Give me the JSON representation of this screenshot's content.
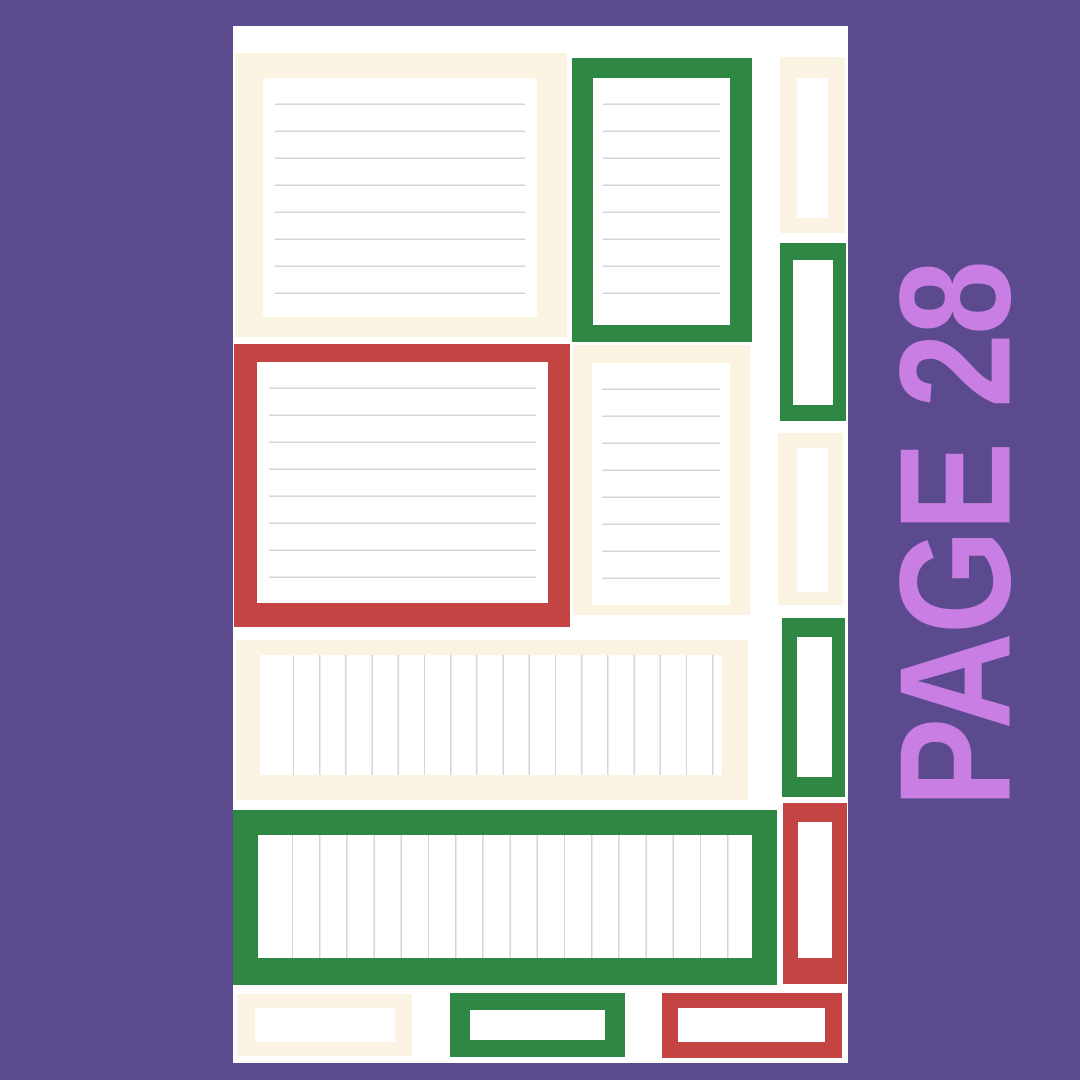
{
  "page": {
    "label": "PAGE 28"
  },
  "palette": {
    "background": "#5b4a8e",
    "label_text": "#c87ee2",
    "sheet": "#ffffff",
    "cream": "#faf3e1",
    "green": "#2e8742",
    "red": "#c44444",
    "rule_line": "#d5d5d8"
  },
  "sheet": {
    "stickers": [
      {
        "name": "cream-lined-note-large",
        "frame": "cream",
        "lines": "horizontal",
        "line_count": 8
      },
      {
        "name": "green-lined-note",
        "frame": "green",
        "lines": "horizontal",
        "line_count": 8
      },
      {
        "name": "cream-side-tab-top",
        "frame": "cream",
        "lines": "none"
      },
      {
        "name": "green-side-tab-top",
        "frame": "green",
        "lines": "none"
      },
      {
        "name": "red-lined-note-large",
        "frame": "red",
        "lines": "horizontal",
        "line_count": 8
      },
      {
        "name": "cream-lined-note-small",
        "frame": "cream",
        "lines": "horizontal",
        "line_count": 8
      },
      {
        "name": "cream-side-tab-middle",
        "frame": "cream",
        "lines": "none"
      },
      {
        "name": "green-side-tab-lower",
        "frame": "green",
        "lines": "none"
      },
      {
        "name": "cream-checklist-strip",
        "frame": "cream",
        "lines": "vertical",
        "line_count": 18
      },
      {
        "name": "green-checklist-strip",
        "frame": "green",
        "lines": "vertical",
        "line_count": 18
      },
      {
        "name": "red-side-tab-bottom",
        "frame": "red",
        "lines": "none"
      },
      {
        "name": "cream-label-small",
        "frame": "cream",
        "lines": "none"
      },
      {
        "name": "green-label-small",
        "frame": "green",
        "lines": "none"
      },
      {
        "name": "red-label-small",
        "frame": "red",
        "lines": "none"
      }
    ]
  }
}
